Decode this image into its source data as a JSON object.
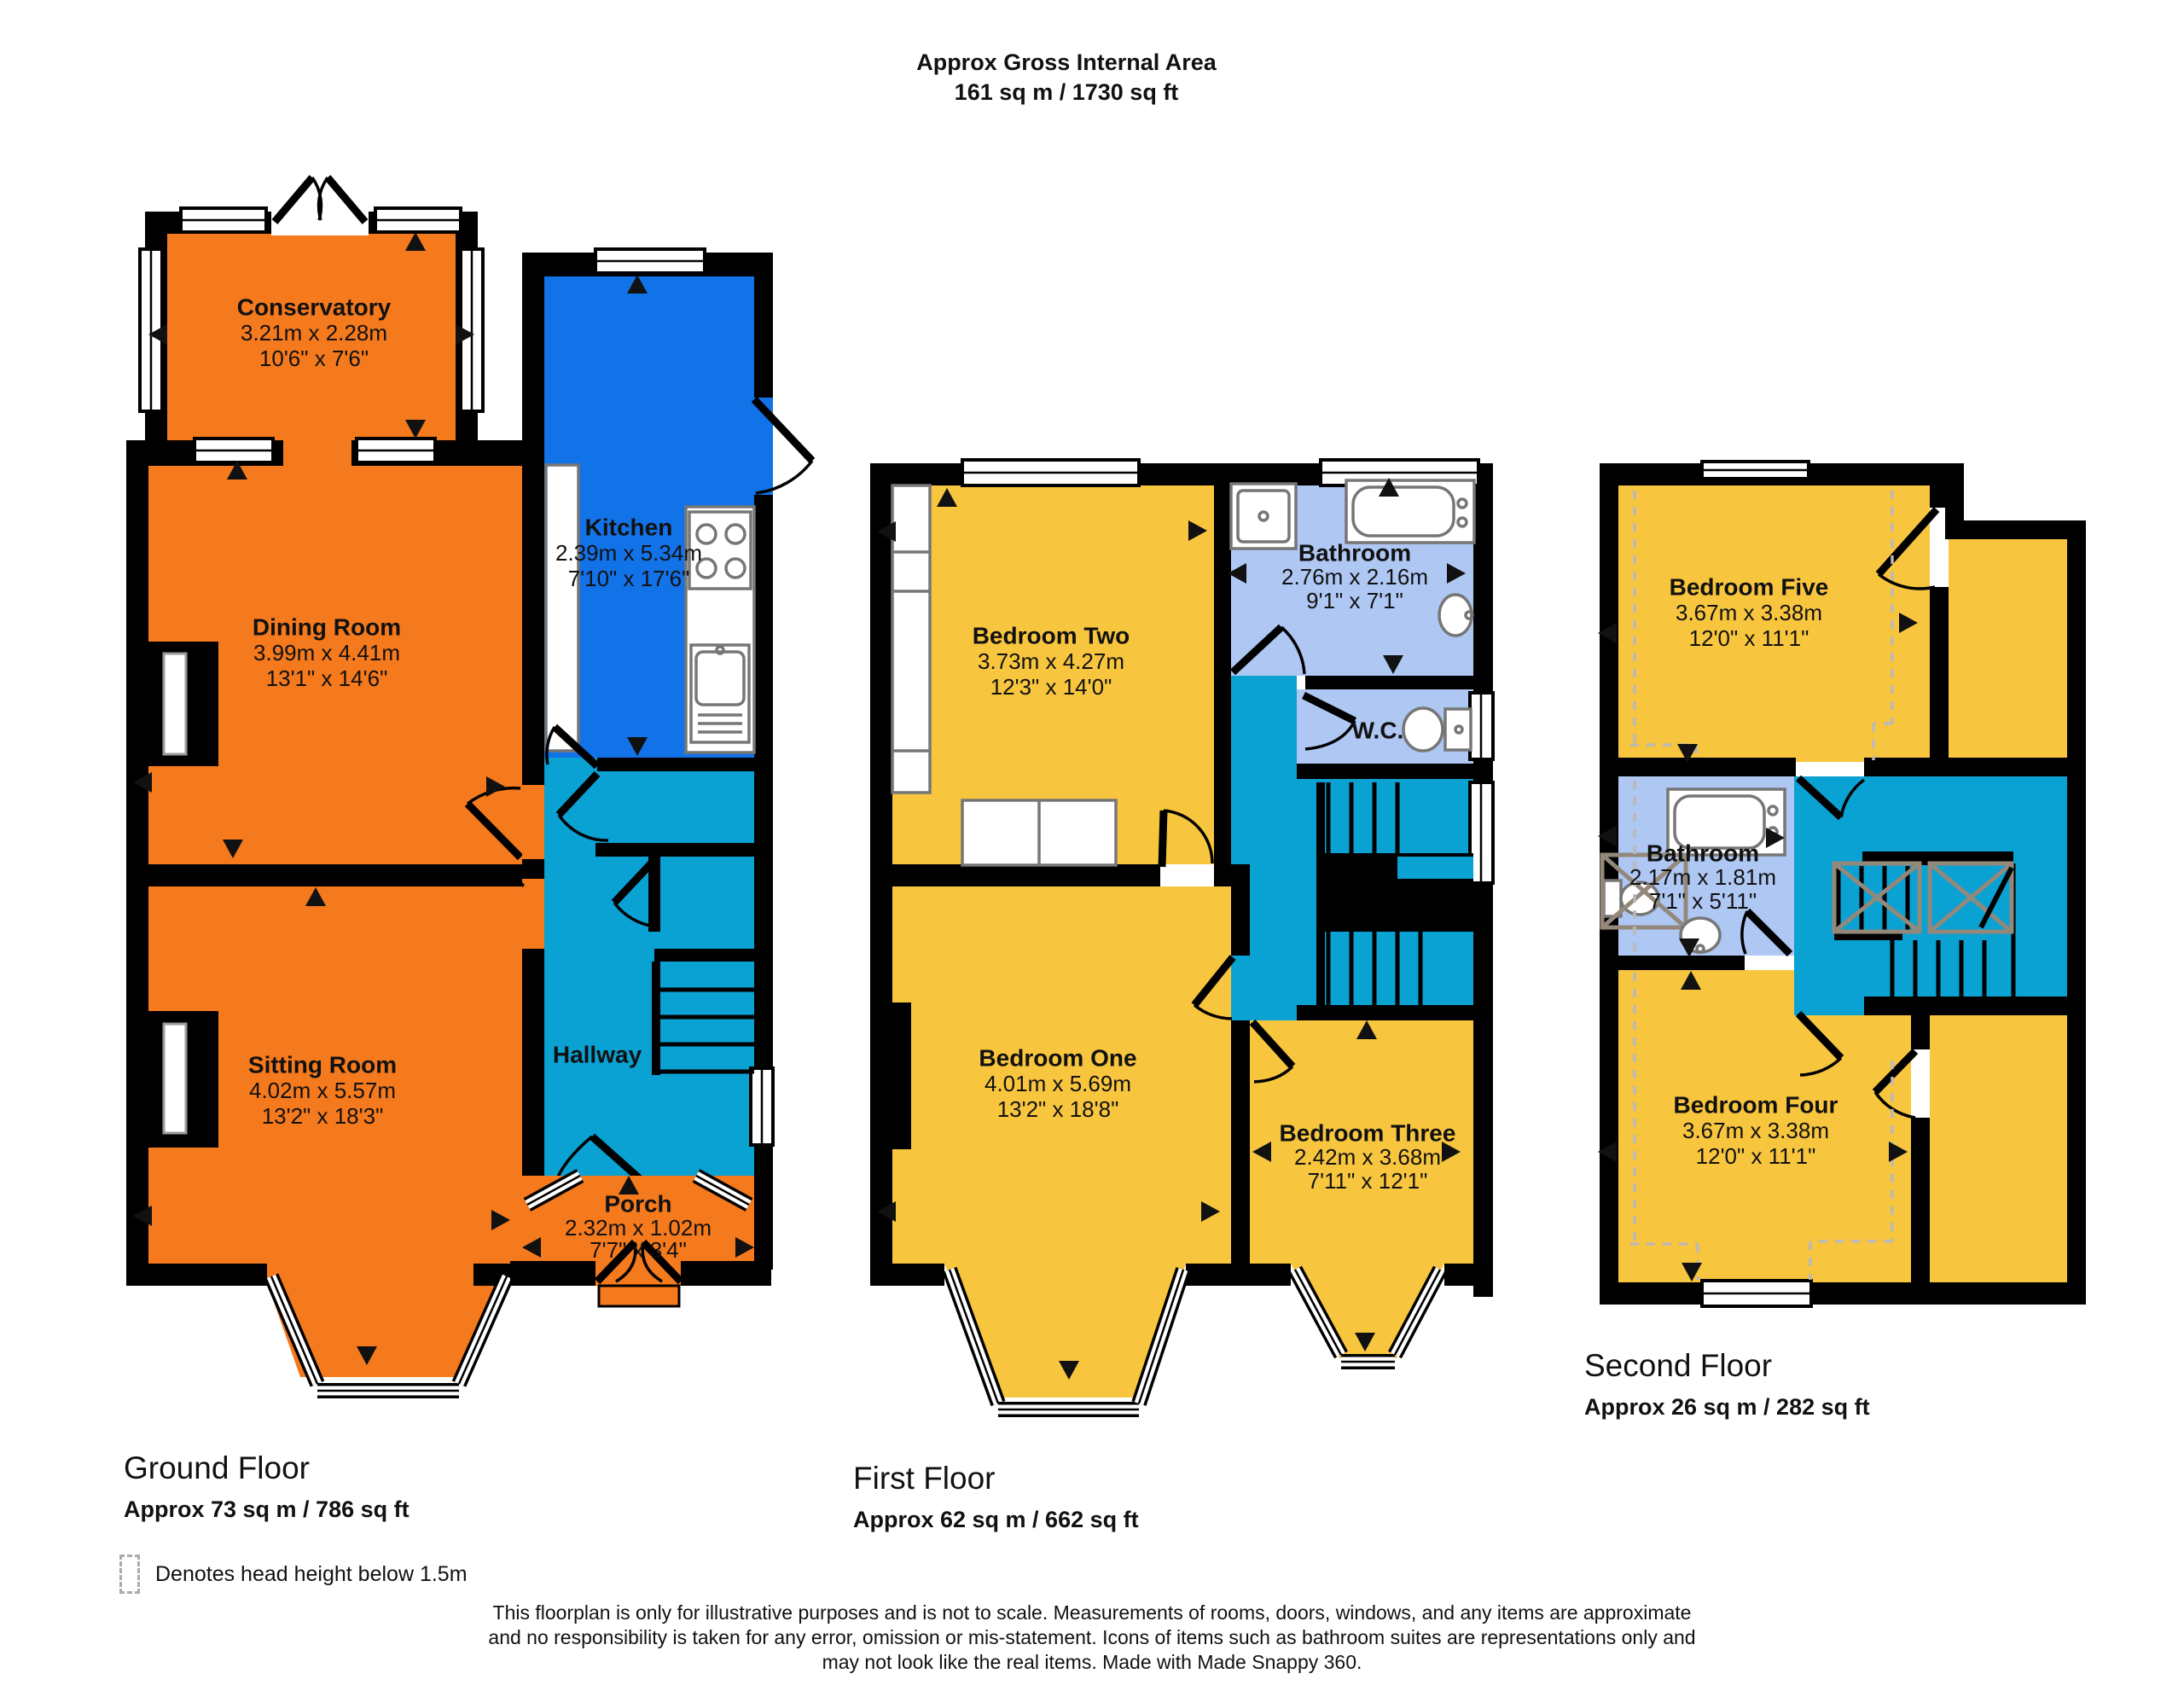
{
  "title": {
    "line1": "Approx Gross Internal Area",
    "line2": "161 sq m / 1730 sq ft"
  },
  "colors": {
    "orange": "#F5791D",
    "blue": "#1272E8",
    "teal": "#0AA1D3",
    "yellow": "#F8C53E",
    "bathroom": "#AFC7F3",
    "wall": "#000000"
  },
  "floors": [
    {
      "label": "Ground Floor",
      "area": "Approx 73 sq m / 786 sq ft",
      "rooms": [
        {
          "name": "Conservatory",
          "metric": "3.21m x 2.28m",
          "imperial": "10'6\" x 7'6\""
        },
        {
          "name": "Kitchen",
          "metric": "2.39m x 5.34m",
          "imperial": "7'10\" x 17'6\""
        },
        {
          "name": "Dining Room",
          "metric": "3.99m x 4.41m",
          "imperial": "13'1\" x 14'6\""
        },
        {
          "name": "Sitting Room",
          "metric": "4.02m x 5.57m",
          "imperial": "13'2\" x 18'3\""
        },
        {
          "name": "Hallway"
        },
        {
          "name": "Porch",
          "metric": "2.32m x 1.02m",
          "imperial": "7'7\" x 3'4\""
        }
      ]
    },
    {
      "label": "First Floor",
      "area": "Approx 62 sq m / 662 sq ft",
      "rooms": [
        {
          "name": "Bedroom Two",
          "metric": "3.73m x 4.27m",
          "imperial": "12'3\" x 14'0\""
        },
        {
          "name": "Bathroom",
          "metric": "2.76m x 2.16m",
          "imperial": "9'1\" x 7'1\""
        },
        {
          "name": "W.C."
        },
        {
          "name": "Bedroom One",
          "metric": "4.01m x 5.69m",
          "imperial": "13'2\" x 18'8\""
        },
        {
          "name": "Bedroom Three",
          "metric": "2.42m x 3.68m",
          "imperial": "7'11\" x 12'1\""
        }
      ]
    },
    {
      "label": "Second Floor",
      "area": "Approx 26 sq m / 282 sq ft",
      "rooms": [
        {
          "name": "Bedroom Five",
          "metric": "3.67m x 3.38m",
          "imperial": "12'0\" x 11'1\""
        },
        {
          "name": "Bathroom",
          "metric": "2.17m x 1.81m",
          "imperial": "7'1\" x 5'11\""
        },
        {
          "name": "Bedroom Four",
          "metric": "3.67m x 3.38m",
          "imperial": "12'0\" x 11'1\""
        }
      ]
    }
  ],
  "legend": {
    "text": "Denotes head height below 1.5m"
  },
  "disclaimer": "This floorplan is only for illustrative purposes and is not to scale. Measurements of rooms, doors, windows, and any items are approximate and no responsibility is taken for any error, omission or mis-statement. Icons of items such as bathroom suites are representations only and may not look like the real items. Made with Made Snappy 360."
}
